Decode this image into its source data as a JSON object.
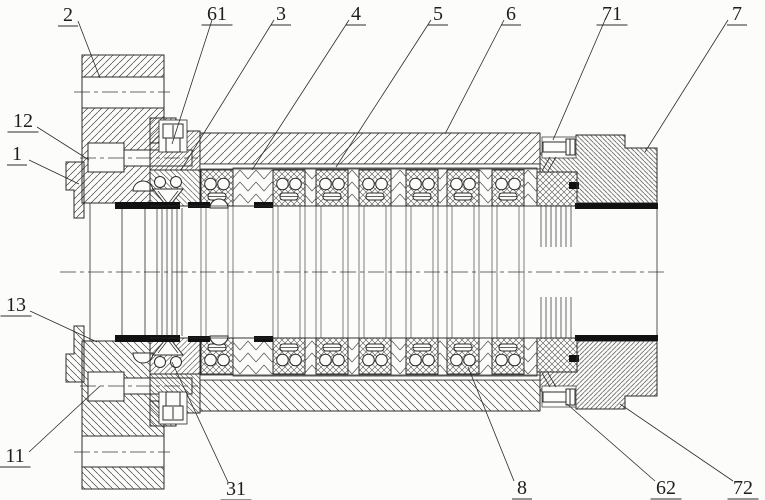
{
  "figure": {
    "kind": "patent-cross-section-drawing",
    "background_color": "#fcfcfb",
    "line_color": "#2b2b2b",
    "centerline_color": "#3a3a3a"
  },
  "callouts": [
    {
      "id": "2",
      "text": "2",
      "x": 68,
      "y": 8,
      "leader": {
        "x1": 78,
        "y1": 21,
        "x2": 100,
        "y2": 78
      }
    },
    {
      "id": "61",
      "text": "61",
      "x": 217,
      "y": 7,
      "leader": {
        "x1": 212,
        "y1": 20,
        "x2": 172,
        "y2": 144
      }
    },
    {
      "id": "3",
      "text": "3",
      "x": 281,
      "y": 7,
      "leader": {
        "x1": 274,
        "y1": 20,
        "x2": 181,
        "y2": 170
      }
    },
    {
      "id": "4",
      "text": "4",
      "x": 356,
      "y": 7,
      "leader": {
        "x1": 349,
        "y1": 20,
        "x2": 252,
        "y2": 170
      }
    },
    {
      "id": "5",
      "text": "5",
      "x": 438,
      "y": 7,
      "leader": {
        "x1": 431,
        "y1": 20,
        "x2": 336,
        "y2": 167
      }
    },
    {
      "id": "6",
      "text": "6",
      "x": 511,
      "y": 7,
      "leader": {
        "x1": 504,
        "y1": 20,
        "x2": 445,
        "y2": 134
      }
    },
    {
      "id": "71",
      "text": "71",
      "x": 612,
      "y": 7,
      "leader": {
        "x1": 605,
        "y1": 20,
        "x2": 553,
        "y2": 140
      }
    },
    {
      "id": "7",
      "text": "7",
      "x": 737,
      "y": 7,
      "leader": {
        "x1": 728,
        "y1": 20,
        "x2": 645,
        "y2": 152
      }
    },
    {
      "id": "12",
      "text": "12",
      "x": 23,
      "y": 114,
      "leader": {
        "x1": 37,
        "y1": 127,
        "x2": 89,
        "y2": 160
      }
    },
    {
      "id": "1",
      "text": "1",
      "x": 17,
      "y": 147,
      "leader": {
        "x1": 29,
        "y1": 160,
        "x2": 79,
        "y2": 184
      }
    },
    {
      "id": "13",
      "text": "13",
      "x": 16,
      "y": 298,
      "leader": {
        "x1": 30,
        "y1": 311,
        "x2": 97,
        "y2": 342
      }
    },
    {
      "id": "11",
      "text": "11",
      "x": 15,
      "y": 449,
      "leader": {
        "x1": 29,
        "y1": 452,
        "x2": 100,
        "y2": 386
      }
    },
    {
      "id": "31",
      "text": "31",
      "x": 236,
      "y": 482,
      "leader": {
        "x1": 228,
        "y1": 482,
        "x2": 172,
        "y2": 362
      }
    },
    {
      "id": "8",
      "text": "8",
      "x": 522,
      "y": 481,
      "leader": {
        "x1": 514,
        "y1": 481,
        "x2": 468,
        "y2": 367
      }
    },
    {
      "id": "62",
      "text": "62",
      "x": 666,
      "y": 481,
      "leader": {
        "x1": 655,
        "y1": 481,
        "x2": 567,
        "y2": 404
      }
    },
    {
      "id": "72",
      "text": "72",
      "x": 743,
      "y": 481,
      "leader": {
        "x1": 733,
        "y1": 481,
        "x2": 620,
        "y2": 404
      }
    }
  ]
}
